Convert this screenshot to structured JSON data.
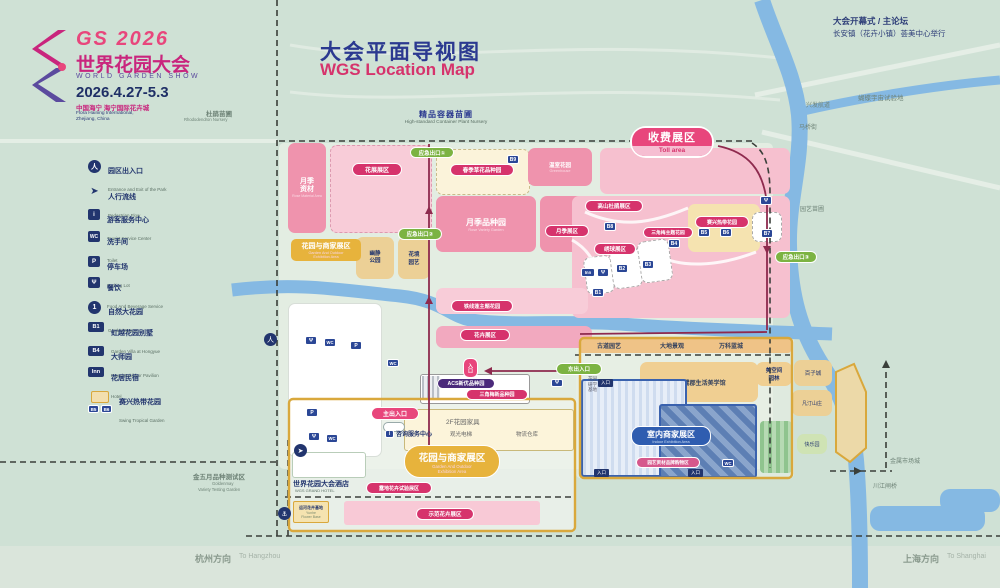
{
  "logo": {
    "gs": "GS 2026",
    "zh": "世界花园大会",
    "en": "WORLD GARDEN SHOW",
    "dates": "2026.4.27-5.3",
    "venue_zh": "中国海宁 海宁国际花卉城",
    "venue_en1": "Flora Haining International,",
    "venue_en2": "Zhejiang, China"
  },
  "title": {
    "zh": "大会平面导视图",
    "en": "WGS Location Map"
  },
  "note": {
    "line1": "大会开幕式 / 主论坛",
    "line2": "长安镇（花卉小镇）荟美中心举行"
  },
  "legend": {
    "items": [
      {
        "icon": "人",
        "zh": "园区出入口",
        "en": "Entrance and Exit of the Park"
      },
      {
        "icon": "➤",
        "zh": "人行流线",
        "en": "Pedestrian Flow"
      },
      {
        "icon": "i",
        "zh": "游客服务中心",
        "en": "Tourist Service Center"
      },
      {
        "icon": "WC",
        "zh": "洗手间",
        "en": "Toilet"
      },
      {
        "icon": "P",
        "zh": "停车场",
        "en": "Parking Lot"
      },
      {
        "icon": "Ψ",
        "zh": "餐饮",
        "en": "Food And Beverage Service"
      },
      {
        "icon": "1",
        "zh": "自然大花园",
        "en": "Garden Space"
      },
      {
        "icon": "B1",
        "zh": "虹越花园别墅",
        "en": "Garden Villa at Hongyue"
      },
      {
        "icon": "B4",
        "zh": "大师园",
        "en": "Brand Exhibitor Pavilion"
      },
      {
        "icon": "Inn",
        "zh": "花居民宿",
        "en": "Hotel"
      },
      {
        "icon": "",
        "zh": "赛兴热带花园",
        "en": "Swing Tropical Garden"
      }
    ]
  },
  "toll": {
    "zh": "收费展区",
    "en": "Toll area"
  },
  "exits": {
    "e1": "应急出口①",
    "e2": "应急出口②",
    "e3": "应急出口③"
  },
  "gates": {
    "main": "主出入口",
    "east": "东出入口",
    "mini": "入口"
  },
  "areas": {
    "nursery_zh": "精品容器苗圃",
    "nursery_en": "High-standard Container Plant Nursery",
    "rose_material": "月季资材",
    "rose_material_en": "Rose Material Area",
    "flower_show": "花展展区",
    "spring_flowers": "春季草花品种园",
    "greenhouse_zh": "温室花园",
    "greenhouse_en": "Greenhouse",
    "rose_variety_zh": "月季品种园",
    "rose_variety_en": "Rose Variety Garden",
    "rose_area": "月季展区",
    "rhododendron": "高山杜鹃展区",
    "hydrangea": "绣球展区",
    "bougainvillea_theme": "三角梅主题花园",
    "tropical": "赛兴热带花园",
    "clematis": "铁线莲主题花园",
    "flower_strip": "花卉展区",
    "quiet_park": "幽静公园",
    "garden_art1": "花境",
    "garden_art2": "园艺",
    "acs": "ACS新优品种园",
    "bougainvillea_new": "三角梅新品种园",
    "f2": "2F花园家具",
    "elevator": "观光电梯",
    "warehouse": "物流仓库",
    "office": "咨询服务中心",
    "gb_zone_zh": "花园与商家展区",
    "gb_zone_en1": "Garden And Outdoor",
    "gb_zone_en2": "Exhibition Area",
    "hotel_zh": "世界花园大会酒店",
    "hotel_en": "WGS GRAND HOTEL",
    "trial": "露地花卉试验展区",
    "canal_base_zh": "运河花卉基地",
    "canal_base_en1": "Yunhe",
    "canal_base_en2": "Flower Base",
    "demo": "示范花卉展区",
    "indoor_zh": "室内商家展区",
    "indoor_en": "Indoor Exhibition Area",
    "shopping": "园艺资材品牌购物区",
    "aesthetics": "白鹭郡生活美学馆",
    "study1": "花园",
    "study2": "研学",
    "study3": "基地",
    "space1": "美空间",
    "space2": "园林",
    "s1": "古道园艺",
    "s2": "大地景观",
    "s3": "万科蓝城"
  },
  "surroundings": {
    "rhodo_zh": "杜鹃苗圃",
    "rhodo_en": "Rhododendron Nursery",
    "waterway": "兴发航道",
    "maqiao": "马桥街",
    "butterfly": "蝴蝶宇宙试验地",
    "nursery2": "园艺苗圃",
    "metal": "金属市场城",
    "bridge": "川江闸桥",
    "baizi": "百子城",
    "fanting": "凡汀山庄",
    "kuaile": "快乐园",
    "goldenmay_zh": "金五月品种测试区",
    "goldenmay_en1": "Goldenmay",
    "goldenmay_en2": "Variety Testing Garden"
  },
  "directions": {
    "hz_zh": "杭州方向",
    "hz_en": "To Hangzhou",
    "sh_zh": "上海方向",
    "sh_en": "To Shanghai"
  },
  "badges": {
    "b1": "B1",
    "b2": "B2",
    "b3": "B3",
    "b4": "B4",
    "b5": "B5",
    "b6": "B6",
    "b7": "B7",
    "b8": "B8",
    "b9": "B9",
    "wc": "WC",
    "p": "P",
    "i": "i",
    "food": "Ψ",
    "inn": "Inn",
    "entry": "入口"
  },
  "markers": {
    "flow": "➤",
    "dock": "⚓",
    "gate": "人"
  },
  "colors": {
    "accent_magenta": "#d6336c",
    "accent_pink": "#e8467c",
    "navy": "#22356e",
    "green_pill": "#7cb342",
    "river": "#85b9e3",
    "boundary_yellow": "#d9a83c"
  }
}
